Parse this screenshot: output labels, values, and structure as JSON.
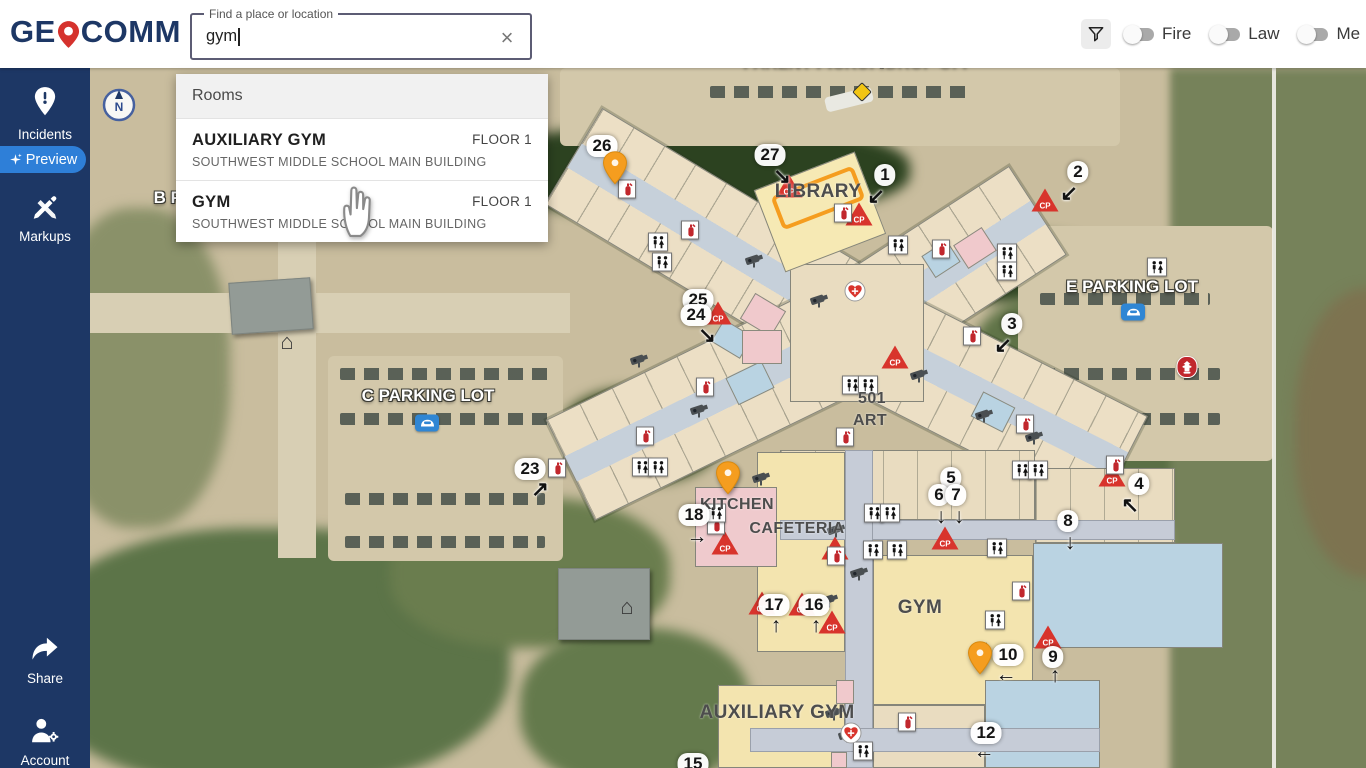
{
  "header": {
    "logo": {
      "pre": "GE",
      "post": "COMM"
    },
    "search": {
      "label": "Find a place or location",
      "value": "gym",
      "clear": "×"
    },
    "filters": {
      "f1": "Fire",
      "f2": "Law",
      "f3": "Me"
    }
  },
  "sidebar": {
    "incidents": "Incidents",
    "preview": "Preview",
    "markups": "Markups",
    "share": "Share",
    "account": "Account"
  },
  "results": {
    "section": "Rooms",
    "items": [
      {
        "name": "AUXILIARY GYM",
        "building": "SOUTHWEST MIDDLE SCHOOL MAIN BUILDING",
        "floor": "FLOOR 1"
      },
      {
        "name": "GYM",
        "building": "SOUTHWEST MIDDLE SCHOOL MAIN BUILDING",
        "floor": "FLOOR 1"
      }
    ]
  },
  "map": {
    "colors": {
      "pin_orange": "#f59d1f",
      "cp_red": "#d8342c",
      "navy": "#1d3765",
      "highlight_orange": "#f59d1f"
    },
    "labels": [
      {
        "t": "PARENT PICKUP/DROP OFF",
        "x": 768,
        "y": -6,
        "s": "parking"
      },
      {
        "t": "B PARKING LOT",
        "x": 130,
        "y": 130,
        "s": "parking"
      },
      {
        "t": "C PARKING LOT",
        "x": 338,
        "y": 328,
        "s": "parking"
      },
      {
        "t": "E PARKING LOT",
        "x": 1042,
        "y": 219,
        "s": "parking"
      },
      {
        "t": "LIBRARY",
        "x": 728,
        "y": 124,
        "s": "room room-lg"
      },
      {
        "t": "501",
        "x": 782,
        "y": 331,
        "s": "room"
      },
      {
        "t": "ART",
        "x": 780,
        "y": 353,
        "s": "room"
      },
      {
        "t": "KITCHEN",
        "x": 647,
        "y": 437,
        "s": "room"
      },
      {
        "t": "CAFETERIA",
        "x": 707,
        "y": 461,
        "s": "room"
      },
      {
        "t": "GYM",
        "x": 830,
        "y": 540,
        "s": "room room-lg"
      },
      {
        "t": "AUXILIARY GYM",
        "x": 687,
        "y": 645,
        "s": "room room-lg"
      }
    ],
    "exits": [
      {
        "n": "26",
        "x": 512,
        "y": 78,
        "a": "↘",
        "ax": 524,
        "ay": 100
      },
      {
        "n": "27",
        "x": 680,
        "y": 87,
        "a": "↘",
        "ax": 692,
        "ay": 109
      },
      {
        "n": "1",
        "x": 795,
        "y": 107,
        "a": "↙",
        "ax": 786,
        "ay": 129
      },
      {
        "n": "2",
        "x": 988,
        "y": 104,
        "a": "↙",
        "ax": 979,
        "ay": 126
      },
      {
        "n": "25",
        "x": 608,
        "y": 232
      },
      {
        "n": "24",
        "x": 606,
        "y": 247,
        "a": "↘",
        "ax": 617,
        "ay": 268
      },
      {
        "n": "3",
        "x": 922,
        "y": 256,
        "a": "↙",
        "ax": 913,
        "ay": 278
      },
      {
        "n": "23",
        "x": 440,
        "y": 401,
        "a": "↗",
        "ax": 450,
        "ay": 422
      },
      {
        "n": "4",
        "x": 1049,
        "y": 416,
        "a": "↖",
        "ax": 1040,
        "ay": 438
      },
      {
        "n": "8",
        "x": 978,
        "y": 453,
        "a": "↓",
        "ax": 980,
        "ay": 475
      },
      {
        "n": "18",
        "x": 604,
        "y": 447,
        "a": "→",
        "ax": 607,
        "ay": 469
      },
      {
        "n": "5",
        "x": 861,
        "y": 410
      },
      {
        "n": "6",
        "x": 849,
        "y": 427,
        "a": "↓",
        "ax": 851,
        "ay": 449
      },
      {
        "n": "7",
        "x": 866,
        "y": 427,
        "a": "↓",
        "ax": 869,
        "ay": 449
      },
      {
        "n": "17",
        "x": 684,
        "y": 537,
        "a": "↑",
        "ax": 686,
        "ay": 558
      },
      {
        "n": "16",
        "x": 724,
        "y": 537,
        "a": "↑",
        "ax": 726,
        "ay": 558
      },
      {
        "n": "10",
        "x": 918,
        "y": 587,
        "a": "←",
        "ax": 916,
        "ay": 607
      },
      {
        "n": "9",
        "x": 963,
        "y": 589,
        "a": "↑",
        "ax": 965,
        "ay": 608
      },
      {
        "n": "12",
        "x": 896,
        "y": 665,
        "a": "←",
        "ax": 894,
        "ay": 684
      },
      {
        "n": "15",
        "x": 603,
        "y": 696
      }
    ],
    "markers": [
      {
        "t": "pin",
        "x": 525,
        "y": 114
      },
      {
        "t": "pin",
        "x": 638,
        "y": 424
      },
      {
        "t": "pin",
        "x": 890,
        "y": 604
      },
      {
        "t": "cp",
        "x": 699,
        "y": 118
      },
      {
        "t": "cp",
        "x": 769,
        "y": 146
      },
      {
        "t": "cp",
        "x": 955,
        "y": 132
      },
      {
        "t": "cp",
        "x": 628,
        "y": 245
      },
      {
        "t": "cp",
        "x": 805,
        "y": 289
      },
      {
        "t": "cp",
        "x": 635,
        "y": 475
      },
      {
        "t": "cp",
        "x": 745,
        "y": 480
      },
      {
        "t": "cp",
        "x": 855,
        "y": 470
      },
      {
        "t": "cp",
        "x": 672,
        "y": 535
      },
      {
        "t": "cp",
        "x": 712,
        "y": 536
      },
      {
        "t": "cp",
        "x": 742,
        "y": 554
      },
      {
        "t": "cp",
        "x": 1022,
        "y": 407
      },
      {
        "t": "cp",
        "x": 958,
        "y": 569
      },
      {
        "t": "ext",
        "x": 537,
        "y": 121
      },
      {
        "t": "ext",
        "x": 600,
        "y": 162
      },
      {
        "t": "ext",
        "x": 753,
        "y": 145
      },
      {
        "t": "ext",
        "x": 851,
        "y": 181
      },
      {
        "t": "ext",
        "x": 882,
        "y": 268
      },
      {
        "t": "ext",
        "x": 615,
        "y": 319
      },
      {
        "t": "ext",
        "x": 555,
        "y": 368
      },
      {
        "t": "ext",
        "x": 755,
        "y": 369
      },
      {
        "t": "ext",
        "x": 467,
        "y": 400
      },
      {
        "t": "ext",
        "x": 626,
        "y": 457
      },
      {
        "t": "ext",
        "x": 746,
        "y": 488
      },
      {
        "t": "ext",
        "x": 935,
        "y": 356
      },
      {
        "t": "ext",
        "x": 1025,
        "y": 397
      },
      {
        "t": "ext",
        "x": 931,
        "y": 523
      },
      {
        "t": "ext",
        "x": 817,
        "y": 654
      },
      {
        "t": "wc",
        "x": 568,
        "y": 174
      },
      {
        "t": "wc",
        "x": 572,
        "y": 194
      },
      {
        "t": "wc",
        "x": 808,
        "y": 177
      },
      {
        "t": "wc",
        "x": 917,
        "y": 185
      },
      {
        "t": "wc",
        "x": 917,
        "y": 203
      },
      {
        "t": "wc",
        "x": 762,
        "y": 317
      },
      {
        "t": "wc",
        "x": 778,
        "y": 317
      },
      {
        "t": "wc",
        "x": 552,
        "y": 399
      },
      {
        "t": "wc",
        "x": 568,
        "y": 399
      },
      {
        "t": "wc",
        "x": 626,
        "y": 445
      },
      {
        "t": "wc",
        "x": 784,
        "y": 445
      },
      {
        "t": "wc",
        "x": 800,
        "y": 445
      },
      {
        "t": "wc",
        "x": 783,
        "y": 482
      },
      {
        "t": "wc",
        "x": 807,
        "y": 482
      },
      {
        "t": "wc",
        "x": 907,
        "y": 480
      },
      {
        "t": "wc",
        "x": 905,
        "y": 552
      },
      {
        "t": "wc",
        "x": 932,
        "y": 402
      },
      {
        "t": "wc",
        "x": 948,
        "y": 402
      },
      {
        "t": "wc",
        "x": 773,
        "y": 683
      },
      {
        "t": "wc",
        "x": 1067,
        "y": 199
      },
      {
        "t": "cam",
        "x": 665,
        "y": 192
      },
      {
        "t": "cam",
        "x": 730,
        "y": 232
      },
      {
        "t": "cam",
        "x": 550,
        "y": 292
      },
      {
        "t": "cam",
        "x": 610,
        "y": 342
      },
      {
        "t": "cam",
        "x": 830,
        "y": 307
      },
      {
        "t": "cam",
        "x": 895,
        "y": 347
      },
      {
        "t": "cam",
        "x": 945,
        "y": 369
      },
      {
        "t": "cam",
        "x": 672,
        "y": 410
      },
      {
        "t": "cam",
        "x": 747,
        "y": 462
      },
      {
        "t": "cam",
        "x": 770,
        "y": 505
      },
      {
        "t": "cam",
        "x": 740,
        "y": 532
      },
      {
        "t": "cam",
        "x": 890,
        "y": 580
      },
      {
        "t": "cam",
        "x": 745,
        "y": 645
      },
      {
        "t": "cam",
        "x": 758,
        "y": 667
      },
      {
        "t": "aed",
        "x": 765,
        "y": 223
      },
      {
        "t": "aed",
        "x": 761,
        "y": 665
      },
      {
        "t": "hyd",
        "x": 1097,
        "y": 299
      },
      {
        "t": "car",
        "x": 337,
        "y": 355
      },
      {
        "t": "car",
        "x": 1043,
        "y": 244
      },
      {
        "t": "caution",
        "x": 772,
        "y": 24
      },
      {
        "t": "home",
        "x": 197,
        "y": 274
      },
      {
        "t": "home",
        "x": 537,
        "y": 539
      }
    ]
  }
}
